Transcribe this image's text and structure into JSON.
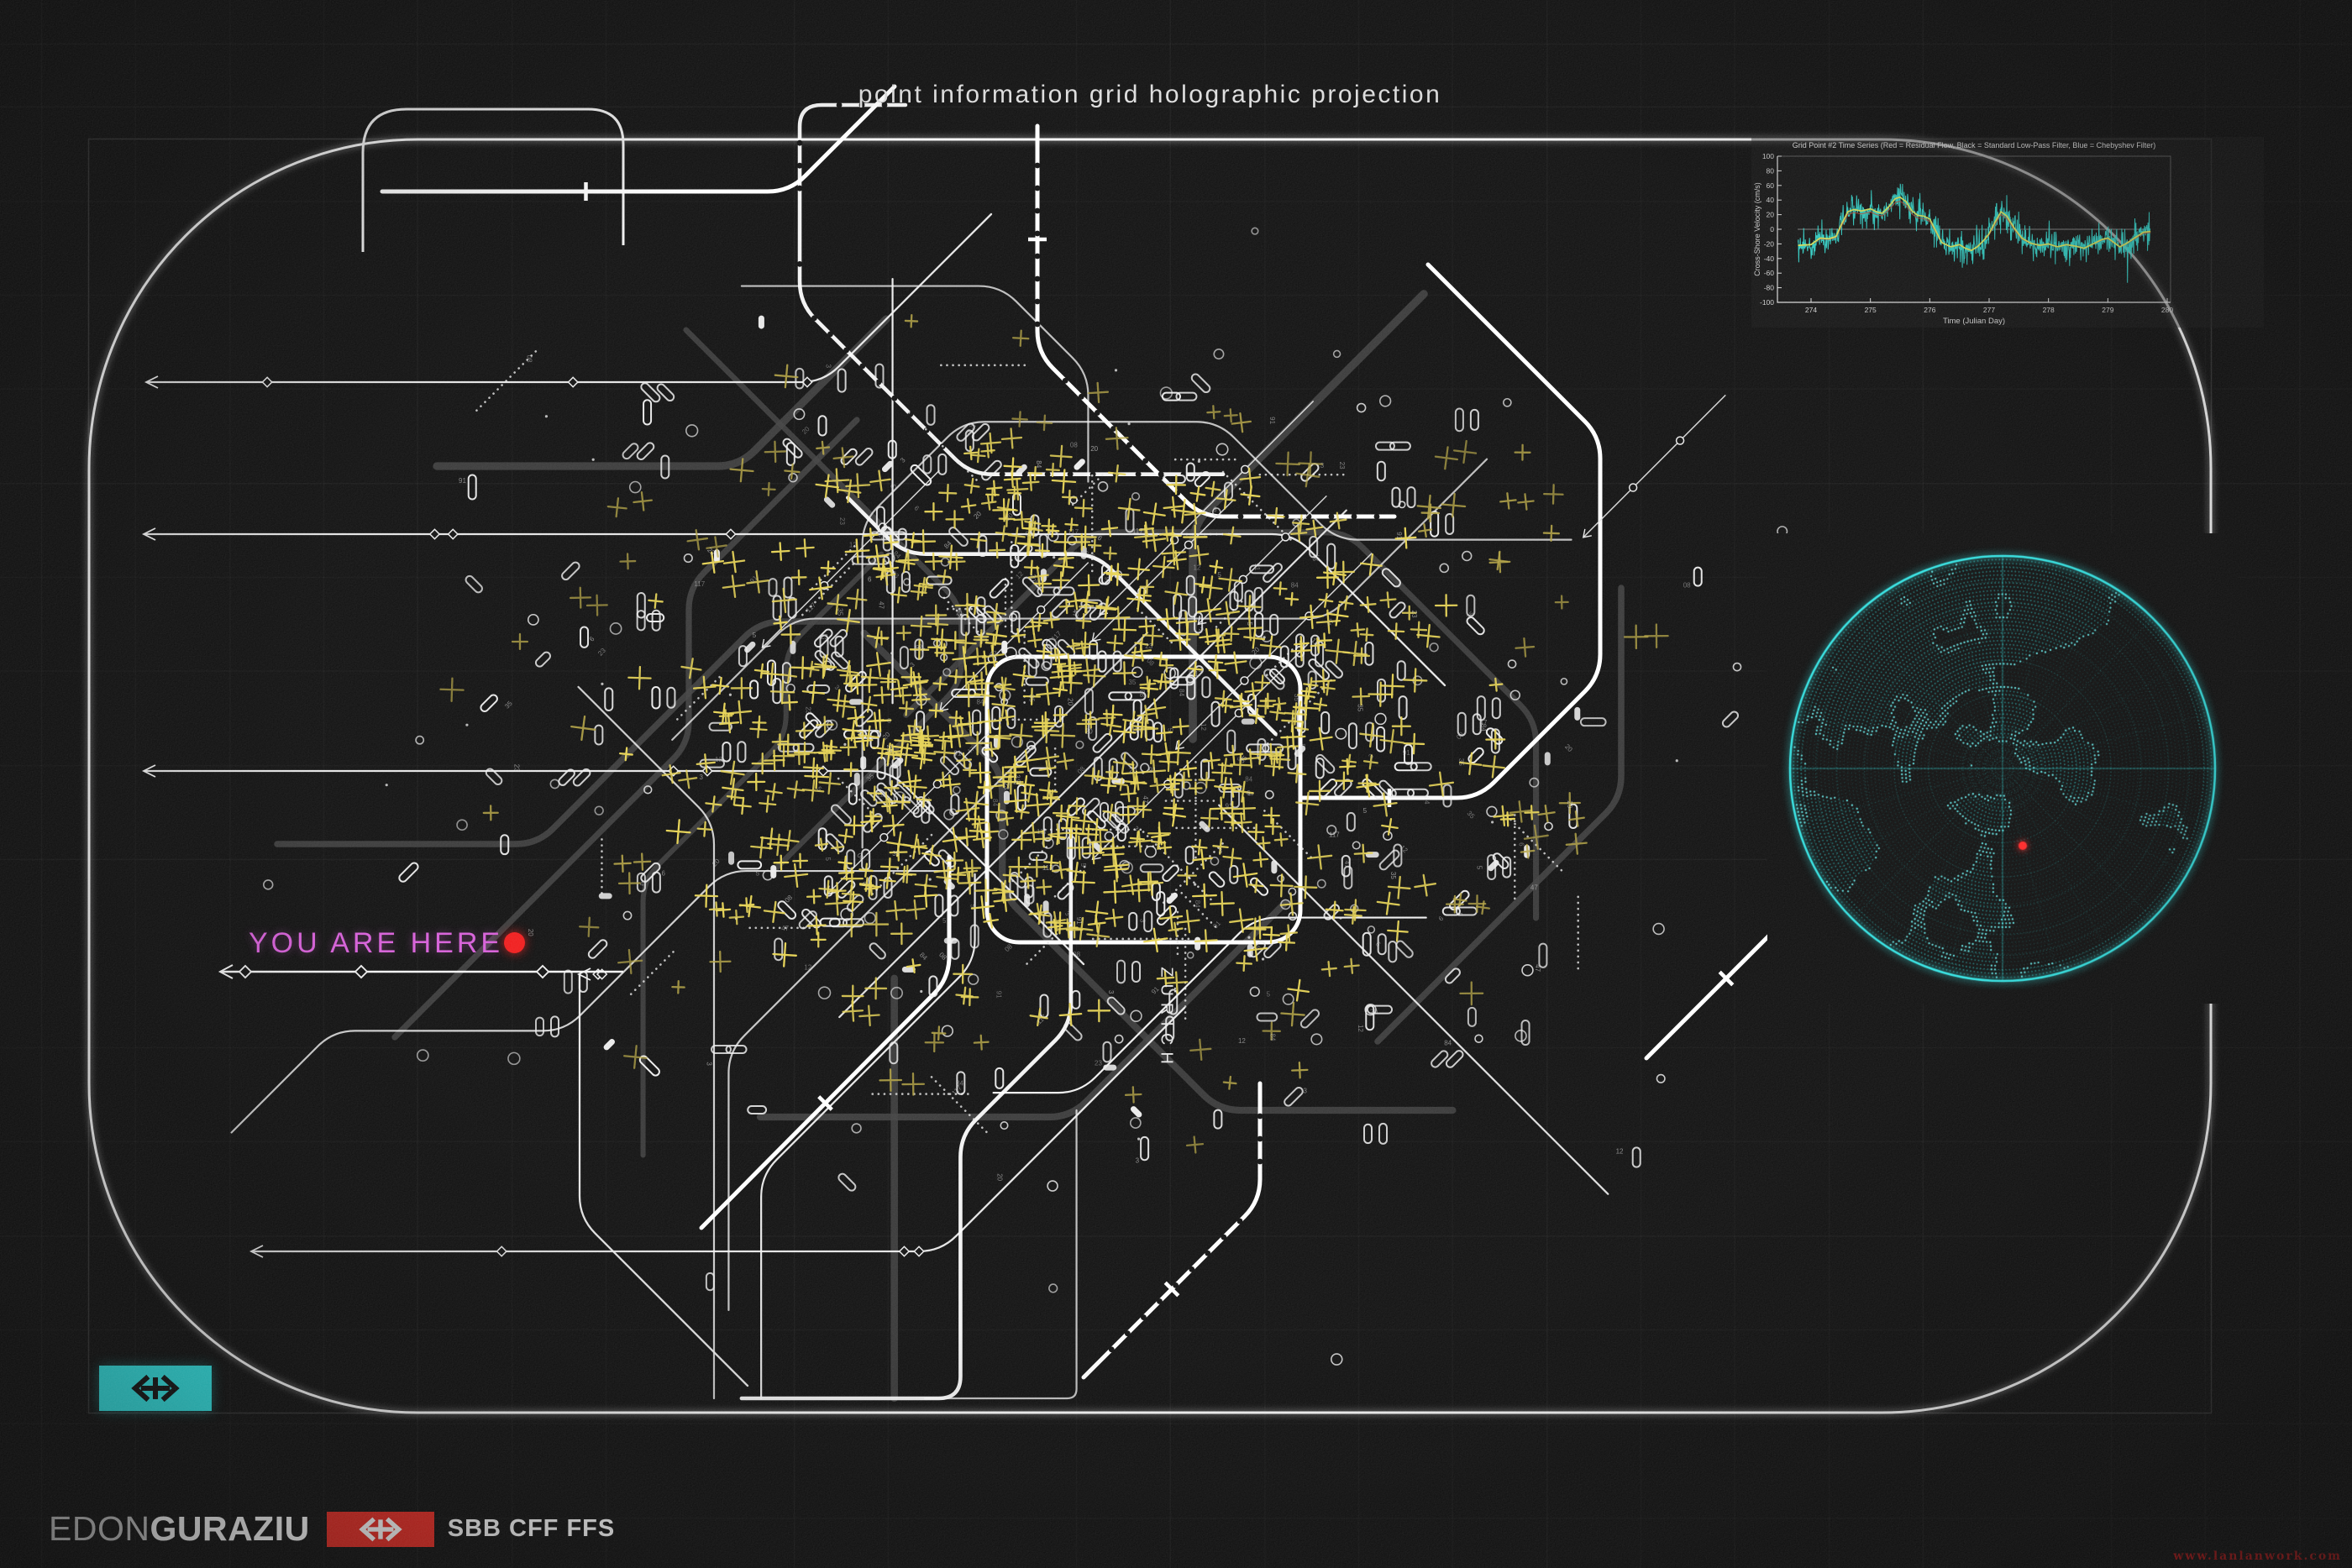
{
  "title": "point information grid holographic projection",
  "map": {
    "city_label": "ZÜRICH",
    "you_are_here": {
      "label": "YOU ARE HERE",
      "text_color": "#d65ad8",
      "dot_color": "#f01616"
    },
    "frame_color": "#f7f7f7",
    "route_color": "#f0f0f0",
    "dim_route_color": "#3d3d3d",
    "station_color": "#ededed",
    "x_mark_bright": "#e6d24f",
    "x_mark_mid": "#b3a23e",
    "x_mark_dim": "#6f6630",
    "seed": 911
  },
  "badge": {
    "bg_color": "#2be9e9",
    "icon": "sbb-double-arrow",
    "icon_color": "#0a0a0a"
  },
  "chart_data": {
    "type": "line",
    "title": "Grid Point #2 Time Series (Red = Residual Flow, Black = Standard Low-Pass Filter, Blue = Chebyshev Filter)",
    "xlabel": "Time (Julian Day)",
    "ylabel": "Cross-Shore Velocity (cm/s)",
    "xlim": [
      273.6,
      280
    ],
    "ylim": [
      -100,
      100
    ],
    "xticks": [
      274,
      275,
      276,
      277,
      278,
      279,
      280
    ],
    "yticks": [
      -100,
      -80,
      -60,
      -40,
      -20,
      0,
      20,
      40,
      60,
      80,
      100
    ],
    "grid": false,
    "legend_position": "in-title",
    "series": [
      {
        "name": "low-pass filter",
        "color": "#d9e457",
        "x": [
          273.78,
          274.0,
          274.15,
          274.3,
          274.42,
          274.52,
          274.62,
          274.72,
          274.85,
          275.0,
          275.1,
          275.2,
          275.3,
          275.42,
          275.5,
          275.6,
          275.7,
          275.8,
          275.9,
          276.0,
          276.1,
          276.2,
          276.35,
          276.5,
          276.6,
          276.7,
          276.8,
          276.9,
          277.0,
          277.1,
          277.2,
          277.3,
          277.42,
          277.55,
          277.7,
          277.85,
          278.0,
          278.15,
          278.3,
          278.45,
          278.6,
          278.75,
          278.9,
          279.0,
          279.1,
          279.2,
          279.3,
          279.45,
          279.6,
          279.7
        ],
        "y": [
          -22,
          -21,
          -12,
          -13,
          -10,
          8,
          24,
          27,
          25,
          28,
          24,
          22,
          30,
          42,
          44,
          38,
          25,
          19,
          18,
          14,
          -2,
          -18,
          -24,
          -21,
          -26,
          -29,
          -24,
          -16,
          -6,
          10,
          24,
          18,
          2,
          -12,
          -19,
          -22,
          -20,
          -24,
          -21,
          -23,
          -26,
          -20,
          -14,
          -12,
          -18,
          -24,
          -20,
          -12,
          -4,
          -3
        ]
      },
      {
        "name": "residual flow (noisy)",
        "color": "#2fd8cd",
        "envelope": "low-pass ± up to 45, high-frequency"
      },
      {
        "name": "chebyshev filter",
        "color": "#b44a33",
        "envelope": "close to low-pass"
      }
    ]
  },
  "globe": {
    "projection": "polar orthographic wireframe",
    "dot_color": "#2ee6e6",
    "coast_color": "#66f5f5",
    "marker_color": "#ff2222"
  },
  "footer": {
    "author_regular": "EDON",
    "author_bold": "GURAZIU",
    "brand": "SBB CFF FFS",
    "brand_bg": "#e8251c"
  },
  "watermark": {
    "text": "www.lanlanwork.com",
    "color": "#a50f0f"
  }
}
